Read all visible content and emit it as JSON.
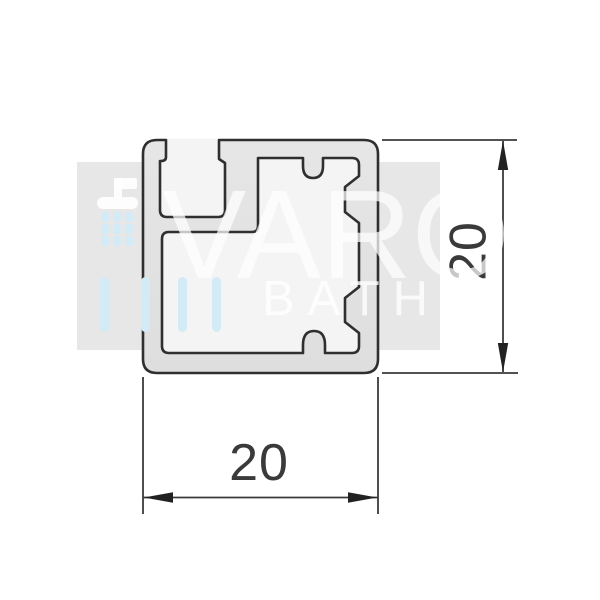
{
  "watermark": {
    "brand": "VARO",
    "sub_brand": "BATH",
    "band_color": "#e7e7e7",
    "accent_color": "#d3ebf7",
    "icon": "shower-head-with-droplets"
  },
  "drawing": {
    "type": "profile-cross-section",
    "outline_color": "#2f2f2f",
    "interior_color": "#f4f4f4",
    "dim_color": "#3a3a3a",
    "width_dim": "20",
    "height_dim": "20"
  }
}
